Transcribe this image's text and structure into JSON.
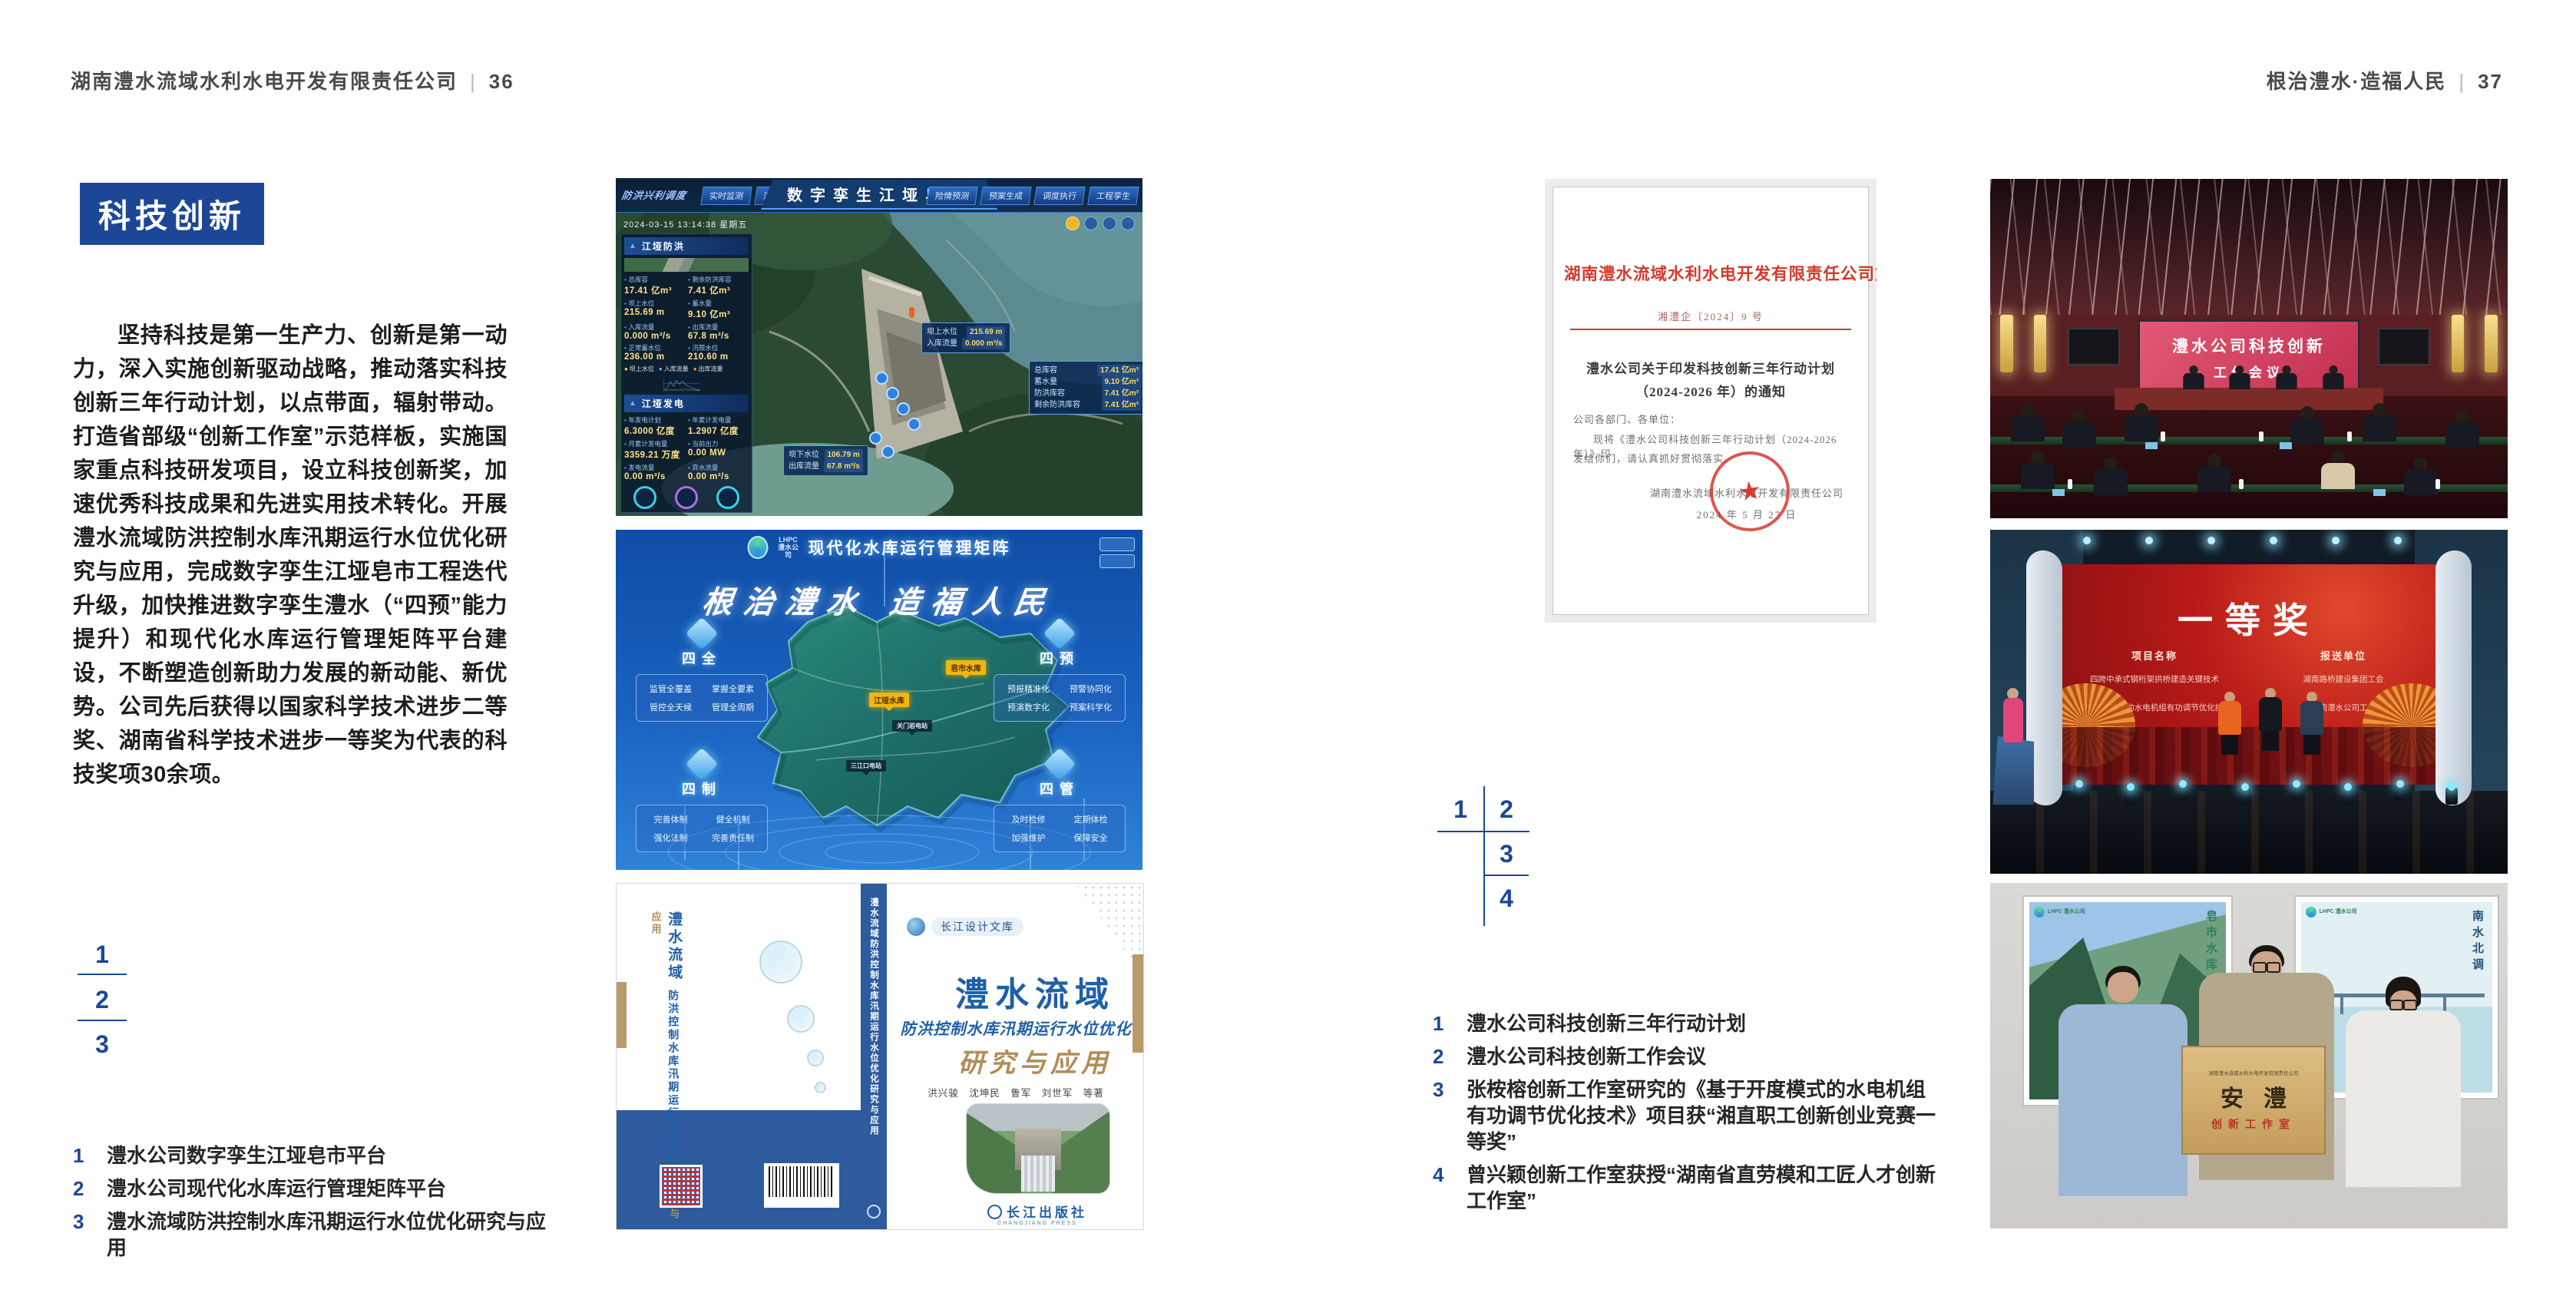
{
  "accent": "#1d4796",
  "left": {
    "header": {
      "company": "湖南澧水流域水利水电开发有限责任公司",
      "divider": "|",
      "page_no": "36"
    },
    "section_title": "科技创新",
    "body": "坚持科技是第一生产力、创新是第一动力，深入实施创新驱动战略，推动落实科技创新三年行动计划，以点带面，辐射带动。打造省部级“创新工作室”示范样板，实施国家重点科技研发项目，设立科技创新奖，加速优秀科技成果和先进实用技术转化。开展澧水流域防洪控制水库汛期运行水位优化研究与应用，完成数字孪生江垭皂市工程迭代升级，加快推进数字孪生澧水（“四预”能力提升）和现代化水库运行管理矩阵平台建设，不断塑造创新助力发展的新动能、新优势。公司先后获得以国家科学技术进步二等奖、湖南省科学技术进步一等奖为代表的科技奖项30余项。",
    "figure_index": {
      "n1": "1",
      "n2": "2",
      "n3": "3"
    },
    "captions": [
      {
        "num": "1",
        "text": "澧水公司数字孪生江垭皂市平台"
      },
      {
        "num": "2",
        "text": "澧水公司现代化水库运行管理矩阵平台"
      },
      {
        "num": "3",
        "text": "澧水流域防洪控制水库汛期运行水位优化研究与应用"
      }
    ]
  },
  "right": {
    "header": {
      "motto": "根治澧水·造福人民",
      "divider": "|",
      "page_no": "37"
    },
    "figure_index": {
      "n1": "1",
      "n2": "2",
      "n3": "3",
      "n4": "4"
    },
    "captions": [
      {
        "num": "1",
        "text": "澧水公司科技创新三年行动计划"
      },
      {
        "num": "2",
        "text": "澧水公司科技创新工作会议"
      },
      {
        "num": "3",
        "text": "张桉榕创新工作室研究的《基于开度模式的水电机组有功调节优化技术》项目获“湘直职工创新创业竞赛一等奖”"
      },
      {
        "num": "4",
        "text": "曾兴颖创新工作室获授“湖南省直劳模和工匠人才创新工作室”"
      }
    ],
    "document": {
      "header": "湖南澧水流域水利水电开发有限责任公司文件",
      "doc_no": "湘澧企〔2024〕9 号",
      "title1": "澧水公司关于印发科技创新三年行动计划",
      "title2": "（2024-2026 年）的通知",
      "salutation": "公司各部门、各单位：",
      "body1": "现将《澧水公司科技创新三年行动计划（2024-2026 年）》印",
      "body2": "发给你们，请认真抓好贯彻落实。",
      "signer": "湖南澧水流域水利水电开发有限责任公司",
      "date": "2024 年 5 月 27 日",
      "seal_star": "★"
    }
  },
  "fig1": {
    "title": "数字孪生江垭皂市",
    "mode_label": "防洪兴利调度",
    "tabs_left": [
      "实时监测",
      "洪水预报",
      "防洪预警"
    ],
    "tabs_right": [
      "险情预测",
      "预案生成",
      "调度执行",
      "工程孪生"
    ],
    "datetime": "2024-03-15 13:14:38 星期五",
    "panel_flood": {
      "title": "江垭防洪",
      "stats": [
        {
          "label": "总库容",
          "value": "17.41 亿m³"
        },
        {
          "label": "剩余防洪库容",
          "value": "7.41 亿m³"
        },
        {
          "label": "坝上水位",
          "value": "215.69 m"
        },
        {
          "label": "蓄水量",
          "value": "9.10 亿m³"
        },
        {
          "label": "入库流量",
          "value": "0.000 m³/s"
        },
        {
          "label": "出库流量",
          "value": "67.8 m³/s"
        },
        {
          "label": "正常蓄水位",
          "value": "236.00 m"
        },
        {
          "label": "汛限水位",
          "value": "210.60 m"
        }
      ]
    },
    "chart_legend": [
      "坝上水位",
      "入库流量",
      "出库流量"
    ],
    "panel_power": {
      "title": "江垭发电",
      "stats": [
        {
          "label": "年发电计划",
          "value": "6.3000 亿度"
        },
        {
          "label": "年累计发电量",
          "value": "1.2907 亿度"
        },
        {
          "label": "月累计发电量",
          "value": "3359.21 万度"
        },
        {
          "label": "当前出力",
          "value": "0.00 MW"
        },
        {
          "label": "发电流量",
          "value": "0.00 m³/s"
        },
        {
          "label": "弃水流量",
          "value": "0.00 m³/s"
        }
      ]
    },
    "callout_up": {
      "l1": "坝上水位",
      "v1": "215.69 m",
      "l2": "入库流量",
      "v2": "0.000 m³/s"
    },
    "callout_right": [
      {
        "label": "总库容",
        "value": "17.41 亿m³"
      },
      {
        "label": "蓄水量",
        "value": "9.10 亿m³"
      },
      {
        "label": "防洪库容",
        "value": "7.41 亿m³"
      },
      {
        "label": "剩余防洪库容",
        "value": "7.41 亿m³"
      }
    ],
    "callout_down": {
      "l1": "坝下水位",
      "v1": "106.79 m",
      "l2": "出库流量",
      "v2": "67.8 m³/s"
    }
  },
  "fig2": {
    "logo_text": "LHPC",
    "logo_sub": "澧水公司",
    "title": "现代化水库运行管理矩阵",
    "slogan": "根治澧水 造福人民",
    "corner_tl": {
      "title": "四全",
      "items": [
        "监管全覆盖",
        "掌握全要素",
        "管控全天候",
        "管理全周期"
      ]
    },
    "corner_tr": {
      "title": "四预",
      "items": [
        "预报精准化",
        "预警协同化",
        "预演数字化",
        "预案科学化"
      ]
    },
    "corner_bl": {
      "title": "四制",
      "items": [
        "完善体制",
        "健全机制",
        "强化法制",
        "完善责任制"
      ]
    },
    "corner_br": {
      "title": "四管",
      "items": [
        "及时检修",
        "定期体检",
        "加强维护",
        "保障安全"
      ]
    },
    "marker1": "皂市水库",
    "marker2": "江垭水库",
    "marker3": "关门岩电站",
    "marker4": "三江口电站"
  },
  "fig3": {
    "series": "长江设计文库",
    "title_main": "澧水流域",
    "title_sub": "防洪控制水库汛期运行水位优化",
    "title_tail": "研究与应用",
    "authors": "洪兴骏　沈坤民　鲁军　刘世军　等著",
    "spine_text": "澧水流域防洪控制水库汛期运行水位优化研究与应用",
    "back_t1": "澧水流域",
    "back_t2": "防洪控制水库汛期运行水位优化",
    "back_t3": "研究与应用",
    "publisher": "长江出版社",
    "publisher_en": "CHANGJIANG PRESS"
  },
  "fig4": {
    "screen_line1": "澧水公司科技创新",
    "screen_line2": "工作会议"
  },
  "fig5": {
    "title": "一等奖",
    "col_project": "项目名称",
    "col_unit": "报送单位",
    "rows": [
      {
        "project": "四跨中承式钢桁架拱桥建造关键技术",
        "unit": "湖南路桥建设集团工会"
      },
      {
        "project": "基于开度模式的水电机组有功调节优化技术",
        "unit": "湖南澧水公司工会"
      }
    ]
  },
  "fig6": {
    "plaque_org": "湖南澧水流域水利水电开发有限责任公司",
    "plaque_calligraphy": "安澧",
    "plaque_workshop": "创新工作室",
    "poster_left_logo": "LHPC 澧水公司",
    "poster_left_text": "皂市水库",
    "poster_right_logo": "LHPC 澧水公司",
    "poster_right_text": "南水北调"
  }
}
